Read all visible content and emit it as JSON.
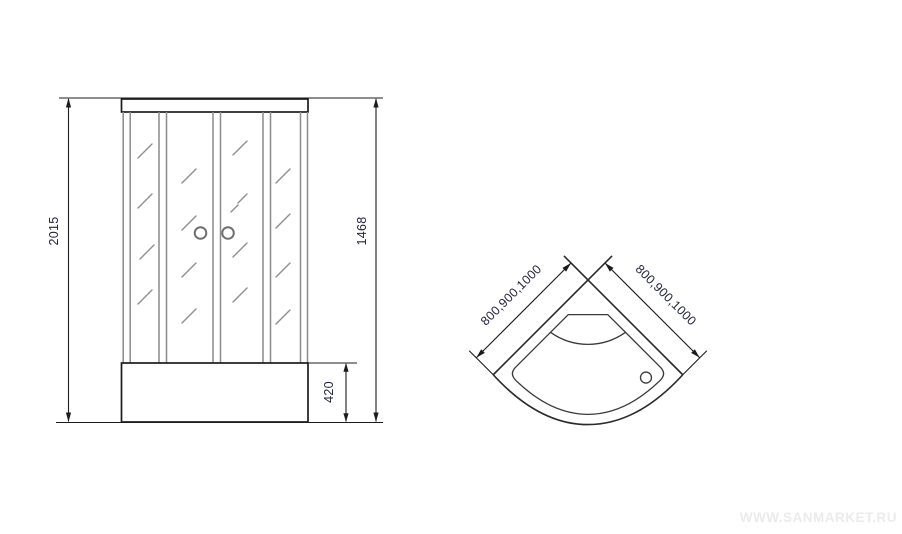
{
  "front_view": {
    "dim_total_height": "2015",
    "dim_glass_height": "1468",
    "dim_tray_height": "420"
  },
  "top_view": {
    "dim_left_sizes": "800,900,1000",
    "dim_right_sizes": "800,900,1000"
  },
  "watermark": {
    "text": "WWW.SANMARKET.RU"
  },
  "colors": {
    "background": "#ffffff",
    "outline": "#1c1c1c",
    "profile_gray": "#8b8b8b",
    "dimension_text": "#23233d",
    "watermark_gray": "#ebebeb"
  }
}
